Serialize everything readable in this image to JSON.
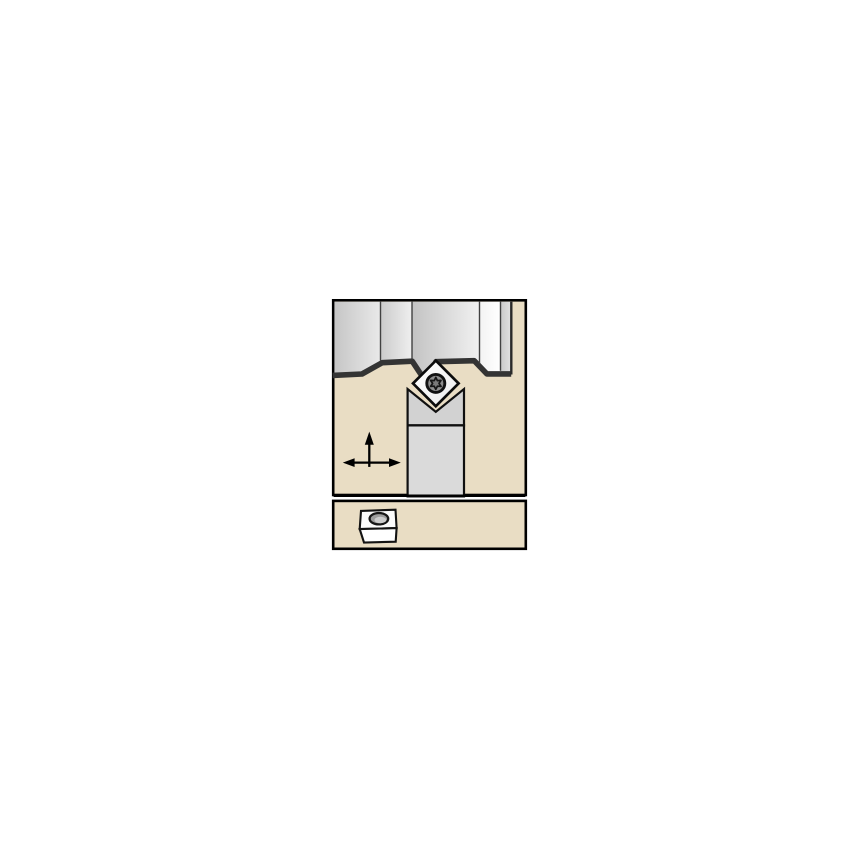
{
  "page": {
    "background": "#ffffff",
    "description": "Technical catalog illustration of a turning tool holder with diamond insert profiling a workpiece, plus a spare insert thumbnail panel below"
  },
  "colors": {
    "panel_fill": "#e9ddc4",
    "panel_border": "#000000",
    "profile_band": "#343434",
    "outline_dark": "#101010",
    "head_fill": "#d2d2d2",
    "shank_fill": "#dadada",
    "screw_fill": "#8e8e8e",
    "torx_fill": "#7a7a7a",
    "hole_fill": "#9c9c9c",
    "arrow_color": "#000000"
  },
  "gradients": [
    {
      "id": "g1",
      "x2": "1",
      "y2": "0",
      "stops": [
        {
          "offset": "0",
          "color": "#c6c6c6"
        },
        {
          "offset": "1",
          "color": "#e9e9e9"
        }
      ]
    },
    {
      "id": "g2",
      "x2": "1",
      "y2": "0",
      "stops": [
        {
          "offset": "0",
          "color": "#cbcbcb"
        },
        {
          "offset": "1",
          "color": "#efefef"
        }
      ]
    },
    {
      "id": "g3",
      "x2": "1",
      "y2": "0",
      "stops": [
        {
          "offset": "0",
          "color": "#c3c3c3"
        },
        {
          "offset": "1",
          "color": "#f1f1f1"
        }
      ]
    },
    {
      "id": "g4",
      "x2": "1",
      "y2": "0",
      "stops": [
        {
          "offset": "0",
          "color": "#f3f3f3"
        },
        {
          "offset": "1",
          "color": "#ffffff"
        }
      ]
    },
    {
      "id": "g5",
      "x2": "1",
      "y2": "0",
      "stops": [
        {
          "offset": "0",
          "color": "#c9c9c9"
        },
        {
          "offset": "1",
          "color": "#e2e2e2"
        }
      ]
    },
    {
      "id": "gIns",
      "x2": "1",
      "y2": "1",
      "stops": [
        {
          "offset": "0",
          "color": "#ffffff"
        },
        {
          "offset": "1",
          "color": "#ededed"
        }
      ]
    }
  ],
  "shapes": [
    {
      "name": "main-panel",
      "interactable": true,
      "type": "rect",
      "attrs": {
        "x": 333.2,
        "y": 300.3,
        "width": 192.6,
        "height": 194.7,
        "fill": "#e9ddc4",
        "stroke": "#000000",
        "stroke-width": 2.6
      }
    },
    {
      "name": "spare-insert-panel",
      "interactable": true,
      "type": "rect",
      "attrs": {
        "x": 333.2,
        "y": 500.9,
        "width": 192.6,
        "height": 47.9,
        "fill": "#e9ddc4",
        "stroke": "#000000",
        "stroke-width": 2.6
      }
    },
    {
      "name": "workpiece-segment-1",
      "interactable": false,
      "type": "polygon",
      "attrs": {
        "points": "334.4,301.7 380.5,301.7 380.5,361 362,371.5 334.4,373",
        "fill": "url(#g1)"
      }
    },
    {
      "name": "workpiece-segment-2",
      "interactable": false,
      "type": "polygon",
      "attrs": {
        "points": "380.5,301.7 412,301.7 412,358.8 380.5,361",
        "fill": "url(#g2)"
      }
    },
    {
      "name": "workpiece-segment-3",
      "interactable": false,
      "type": "polygon",
      "attrs": {
        "points": "412,301.7 479.5,301.7 479.5,364.2 474,358.4 436,359.3 426.5,380.5 412,358.8",
        "fill": "url(#g3)"
      }
    },
    {
      "name": "workpiece-segment-4",
      "interactable": false,
      "type": "polygon",
      "attrs": {
        "points": "479.5,301.7 500.5,301.7 500.5,371.5 486.5,371.5 479.5,364.2",
        "fill": "url(#g4)"
      }
    },
    {
      "name": "workpiece-segment-5",
      "interactable": false,
      "type": "polygon",
      "attrs": {
        "points": "500.5,301.7 511.2,301.7 511.2,371.5 500.5,371.5",
        "fill": "url(#g5)"
      }
    },
    {
      "name": "machined-profile-band",
      "interactable": false,
      "type": "path",
      "attrs": {
        "d": "M 332.6,375.4 L 362,374 L 382.2,362.7 L 412.2,361.2 L 426.6,382.9 L 436,361.7 L 474.2,360.7 L 486.9,373.9 L 511.2,373.9",
        "fill": "none",
        "stroke": "#343434",
        "stroke-width": 5.6,
        "stroke-linejoin": "round"
      }
    },
    {
      "name": "workpiece-right-edge",
      "interactable": false,
      "type": "line",
      "attrs": {
        "x1": 511.3,
        "y1": 374.5,
        "x2": 511.3,
        "y2": 301.7,
        "stroke": "#2a2a2a",
        "stroke-width": 2.4
      }
    },
    {
      "name": "workpiece-divider-1",
      "interactable": false,
      "type": "line",
      "attrs": {
        "x1": 380.5,
        "y1": 301.7,
        "x2": 380.5,
        "y2": 360.6,
        "stroke": "#424242",
        "stroke-width": 1.4
      }
    },
    {
      "name": "workpiece-divider-2",
      "interactable": false,
      "type": "line",
      "attrs": {
        "x1": 412,
        "y1": 301.7,
        "x2": 412,
        "y2": 358.6,
        "stroke": "#424242",
        "stroke-width": 1.4
      }
    },
    {
      "name": "workpiece-divider-3",
      "interactable": false,
      "type": "line",
      "attrs": {
        "x1": 479.5,
        "y1": 301.7,
        "x2": 479.5,
        "y2": 363.6,
        "stroke": "#424242",
        "stroke-width": 1.4
      }
    },
    {
      "name": "workpiece-divider-4",
      "interactable": false,
      "type": "line",
      "attrs": {
        "x1": 500.5,
        "y1": 301.7,
        "x2": 500.5,
        "y2": 370.8,
        "stroke": "#424242",
        "stroke-width": 1.4
      }
    },
    {
      "name": "toolholder-head",
      "interactable": false,
      "type": "polygon",
      "attrs": {
        "points": "407.6,425.4 407.6,389 435.8,411.8 464,389 464,425.4",
        "fill": "#d2d2d2",
        "stroke": "#101010",
        "stroke-width": 2.2
      }
    },
    {
      "name": "toolholder-shank",
      "interactable": false,
      "type": "polygon",
      "attrs": {
        "points": "407.6,425.4 464,425.4 464,496.4 407.6,496.4",
        "fill": "#dadada",
        "stroke": "#101010",
        "stroke-width": 2.2
      }
    },
    {
      "name": "main-panel-bottom-border",
      "interactable": false,
      "type": "line",
      "attrs": {
        "x1": 333.6,
        "y1": 495.7,
        "x2": 525.4,
        "y2": 495.7,
        "stroke": "#000000",
        "stroke-width": 2.5
      }
    },
    {
      "name": "cutting-insert",
      "interactable": false,
      "type": "polygon",
      "attrs": {
        "points": "435.8,360.6 458.6,383.4 435.8,406.2 413,383.4",
        "fill": "url(#gIns)",
        "stroke": "#0c0c0c",
        "stroke-width": 2.7
      }
    },
    {
      "name": "clamp-screw-icon",
      "interactable": false,
      "type": "circle",
      "attrs": {
        "cx": 435.8,
        "cy": 383.4,
        "r": 9.0,
        "fill": "#8e8e8e",
        "stroke": "#121212",
        "stroke-width": 2.9
      }
    },
    {
      "name": "torx-screw-icon",
      "interactable": false,
      "type": "polygon",
      "attrs": {
        "points": "435.8,377.4 437.4,380.6 441.0,380.4 439.0,383.4 441.0,386.4 437.4,386.2 435.8,389.4 434.2,386.2 430.6,386.4 432.6,383.4 430.6,380.4 434.2,380.6",
        "fill": "#7a7a7a",
        "stroke": "#161616",
        "stroke-width": 1.7,
        "stroke-linejoin": "round"
      }
    },
    {
      "name": "feed-arrow-vertical-shaft",
      "interactable": false,
      "type": "line",
      "attrs": {
        "x1": 369.3,
        "y1": 466.9,
        "x2": 369.3,
        "y2": 443.8,
        "stroke": "#000000",
        "stroke-width": 2.3
      }
    },
    {
      "name": "feed-arrow-up-icon",
      "interactable": false,
      "type": "polygon",
      "attrs": {
        "points": "369.3,431.6 364.8,444.8 373.8,444.8",
        "fill": "#000000"
      }
    },
    {
      "name": "feed-arrow-horizontal-shaft",
      "interactable": false,
      "type": "line",
      "attrs": {
        "x1": 352.8,
        "y1": 462.6,
        "x2": 390.2,
        "y2": 462.6,
        "stroke": "#000000",
        "stroke-width": 2.3
      }
    },
    {
      "name": "feed-arrow-left-icon",
      "interactable": false,
      "type": "polygon",
      "attrs": {
        "points": "342.8,462.6 354.6,458.2 354.6,467.0",
        "fill": "#000000"
      }
    },
    {
      "name": "feed-arrow-right-icon",
      "interactable": false,
      "type": "polygon",
      "attrs": {
        "points": "400.8,462.6 389.0,458.2 389.0,467.0",
        "fill": "#000000"
      }
    },
    {
      "name": "spare-insert-top-face",
      "interactable": false,
      "type": "polygon",
      "attrs": {
        "points": "361,510.9 395.5,509.7 396.6,528.1 359.7,529.1",
        "fill": "#fbfbfb",
        "stroke": "#131313",
        "stroke-width": 2.1
      }
    },
    {
      "name": "spare-insert-front-face",
      "interactable": false,
      "type": "polygon",
      "attrs": {
        "points": "359.7,529.1 396.6,528.1 395.7,541.7 364.0,542.5",
        "fill": "#ffffff",
        "stroke": "#131313",
        "stroke-width": 2.1
      }
    },
    {
      "name": "spare-insert-hole",
      "interactable": false,
      "type": "ellipse",
      "attrs": {
        "cx": 378.9,
        "cy": 518.7,
        "rx": 9.3,
        "ry": 5.7,
        "fill": "#9c9c9c",
        "stroke": "#161616",
        "stroke-width": 2.3
      }
    },
    {
      "name": "spare-insert-hole-highlight",
      "interactable": false,
      "type": "ellipse",
      "attrs": {
        "cx": 380.4,
        "cy": 520.0,
        "rx": 5.9,
        "ry": 3.2,
        "fill": "#cccccc"
      }
    }
  ]
}
